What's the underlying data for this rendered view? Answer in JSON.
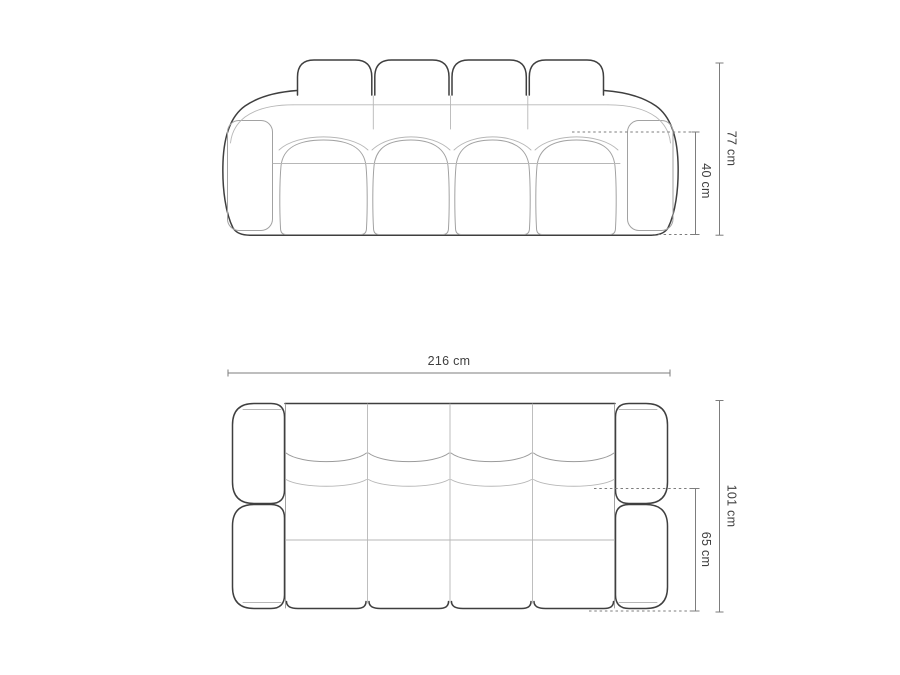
{
  "colors": {
    "background": "#ffffff",
    "outline": "#3f3f3f",
    "panel": "#a2a2a2",
    "seam": "#b7b7b7",
    "seam2": "#9b9b9b",
    "dim": "#7d7d7d",
    "text": "#3f3f3f"
  },
  "views": {
    "front": {
      "dimensions": {
        "overall_height": {
          "label": "77 cm",
          "value": 77,
          "unit": "cm"
        },
        "seat_height": {
          "label": "40 cm",
          "value": 40,
          "unit": "cm"
        }
      }
    },
    "top": {
      "dimensions": {
        "overall_width": {
          "label": "216 cm",
          "value": 216,
          "unit": "cm"
        },
        "overall_depth": {
          "label": "101 cm",
          "value": 101,
          "unit": "cm"
        },
        "seat_depth": {
          "label": "65 cm",
          "value": 65,
          "unit": "cm"
        }
      }
    }
  }
}
